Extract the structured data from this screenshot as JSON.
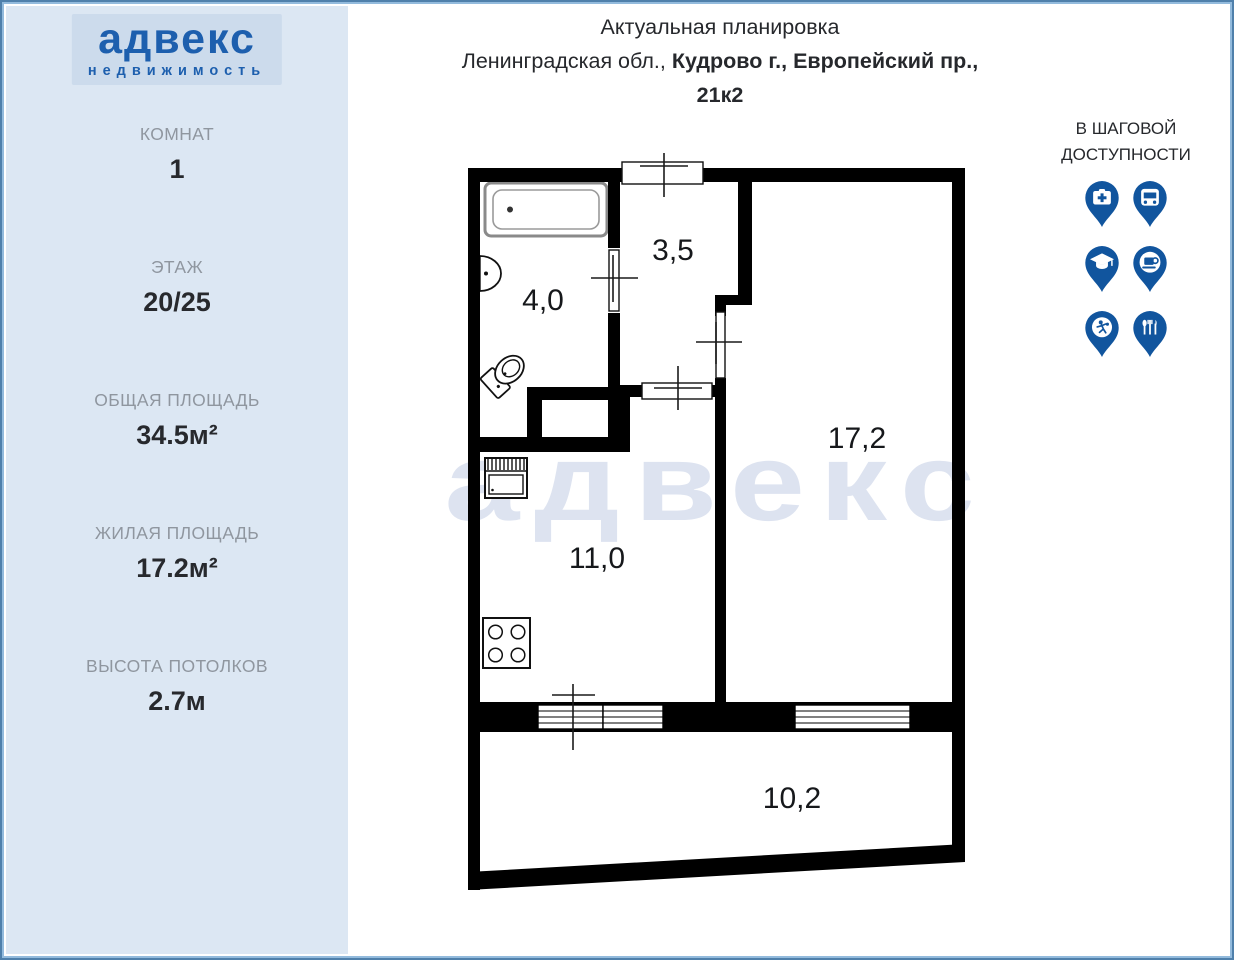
{
  "colors": {
    "brand_blue": "#1d5fae",
    "pin_blue": "#11559e",
    "sidebar_bg": "#dce7f3",
    "watermark_color": "#dde3f0",
    "wall_color": "#000000"
  },
  "logo": {
    "title": "адвекс",
    "subtitle": "недвижимость"
  },
  "sidebar": {
    "stats": [
      {
        "label": "КОМНАТ",
        "value": "1"
      },
      {
        "label": "ЭТАЖ",
        "value": "20/25"
      },
      {
        "label": "ОБЩАЯ ПЛОЩАДЬ",
        "value": "34.5м²"
      },
      {
        "label": "ЖИЛАЯ ПЛОЩАДЬ",
        "value": "17.2м²"
      },
      {
        "label": "ВЫСОТА ПОТОЛКОВ",
        "value": "2.7м"
      }
    ]
  },
  "header": {
    "title": "Актуальная планировка",
    "address_prefix": "Ленинградская обл., ",
    "address_bold": "Кудрово г., Европейский пр.,",
    "address_line2": "21к2"
  },
  "walkability": {
    "title": "В ШАГОВОЙ ДОСТУПНОСТИ",
    "pins": [
      "first-aid",
      "bus",
      "education",
      "cafe",
      "sports",
      "restaurant"
    ]
  },
  "plan": {
    "watermark": "адвекс",
    "rooms": {
      "hallway": "3,5",
      "bathroom": "4,0",
      "living": "17,2",
      "kitchen": "11,0",
      "balcony": "10,2"
    }
  }
}
